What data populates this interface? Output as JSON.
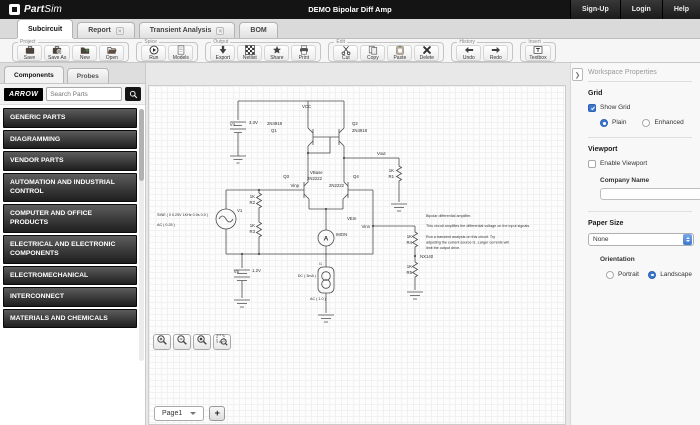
{
  "topbar": {
    "logo_part": "Part",
    "logo_sim": "Sim",
    "title": "DEMO Bipolar Diff Amp",
    "signup": "Sign-Up",
    "login": "Login",
    "help": "Help"
  },
  "tabs": {
    "subcircuit": "Subcircuit",
    "report": "Report",
    "transient": "Transient Analysis",
    "bom": "BOM",
    "close_glyph": "✕"
  },
  "toolbar": {
    "groups": [
      {
        "label": "Project",
        "buttons": [
          {
            "label": "Save"
          },
          {
            "label": "Save As"
          },
          {
            "label": "New"
          },
          {
            "label": "Open"
          }
        ]
      },
      {
        "label": "Spice",
        "buttons": [
          {
            "label": "Run"
          },
          {
            "label": "Models"
          }
        ]
      },
      {
        "label": "Output",
        "buttons": [
          {
            "label": "Export"
          },
          {
            "label": "Netlist"
          },
          {
            "label": "Share"
          },
          {
            "label": "Print"
          }
        ]
      },
      {
        "label": "Edit",
        "buttons": [
          {
            "label": "Cut"
          },
          {
            "label": "Copy"
          },
          {
            "label": "Paste"
          },
          {
            "label": "Delete"
          }
        ]
      },
      {
        "label": "History",
        "buttons": [
          {
            "label": "Undo"
          },
          {
            "label": "Redo"
          }
        ]
      },
      {
        "label": "Insert",
        "buttons": [
          {
            "label": "Textbox"
          }
        ]
      }
    ]
  },
  "sidebar": {
    "tab_components": "Components",
    "tab_probes": "Probes",
    "brand": "ARROW",
    "search_placeholder": "Search Parts",
    "categories": [
      "GENERIC PARTS",
      "DIAGRAMMING",
      "VENDOR PARTS",
      "AUTOMATION AND INDUSTRIAL CONTROL",
      "COMPUTER AND OFFICE PRODUCTS",
      "ELECTRICAL AND ELECTRONIC COMPONENTS",
      "ELECTROMECHANICAL",
      "INTERCONNECT",
      "MATERIALS AND CHEMICALS"
    ]
  },
  "canvas": {
    "page_tab": "Page1",
    "add_page_label": "+"
  },
  "schematic": {
    "vcc": "VCC",
    "v4_name": "V4",
    "v4_value": "3.3V",
    "q1_part": "2N4918",
    "q1_name": "Q1",
    "q2_name": "Q2",
    "q2_part": "2N4918",
    "vbase": "VBase",
    "q3_name": "Q3",
    "vinp": "Vinp",
    "q3_part": "2N2222",
    "q4_part": "2N2222",
    "q4_name": "Q4",
    "vem": "VEm",
    "imon": "IMON",
    "ammeter_label": "A",
    "i1_name": "I1",
    "i1_dc": "DC ( 3mA )",
    "i1_ac": "AC ( 1.0 )",
    "v1_name": "V1",
    "v1_sine": "SINE ( 0 0.25V 1KHz 0.0s 0.0 )",
    "v1_ac": "AC ( 0.25 )",
    "v5_name": "V5",
    "v5_value": "1.2V",
    "vout": "Vout",
    "r1_value": "1K",
    "r1_name": "R1",
    "r2_value": "1K",
    "r2_name": "R2",
    "r3_value": "1K",
    "r3_name": "R3",
    "r4_value": "1K",
    "r4_name": "R4",
    "r5_value": "1K",
    "r5_name": "R5",
    "vinn": "Vinn",
    "nx140": "NX140",
    "note_lines": [
      "Bipolar differential amplifier.",
      "This circuit amplifies the differential voltage on the input signals.",
      "Run a transient analysis on this circuit. Try",
      "adjusting the current source I1. Larger currents will",
      "limit the output drive."
    ]
  },
  "properties": {
    "header": "Workspace Properties",
    "grid_title": "Grid",
    "show_grid": "Show Grid",
    "grid_mode_plain": "Plain",
    "grid_mode_enhanced": "Enhanced",
    "viewport_title": "Viewport",
    "enable_viewport": "Enable Viewport",
    "company_name_label": "Company Name",
    "company_name_value": "",
    "paper_size_title": "Paper Size",
    "paper_size_value": "None",
    "orientation_title": "Orientation",
    "orientation_portrait": "Portrait",
    "orientation_landscape": "Landscape"
  },
  "colors": {
    "accent_blue": "#3b79d1",
    "topbar_bg": "#141414",
    "category_bar": "#2b2b2b"
  }
}
